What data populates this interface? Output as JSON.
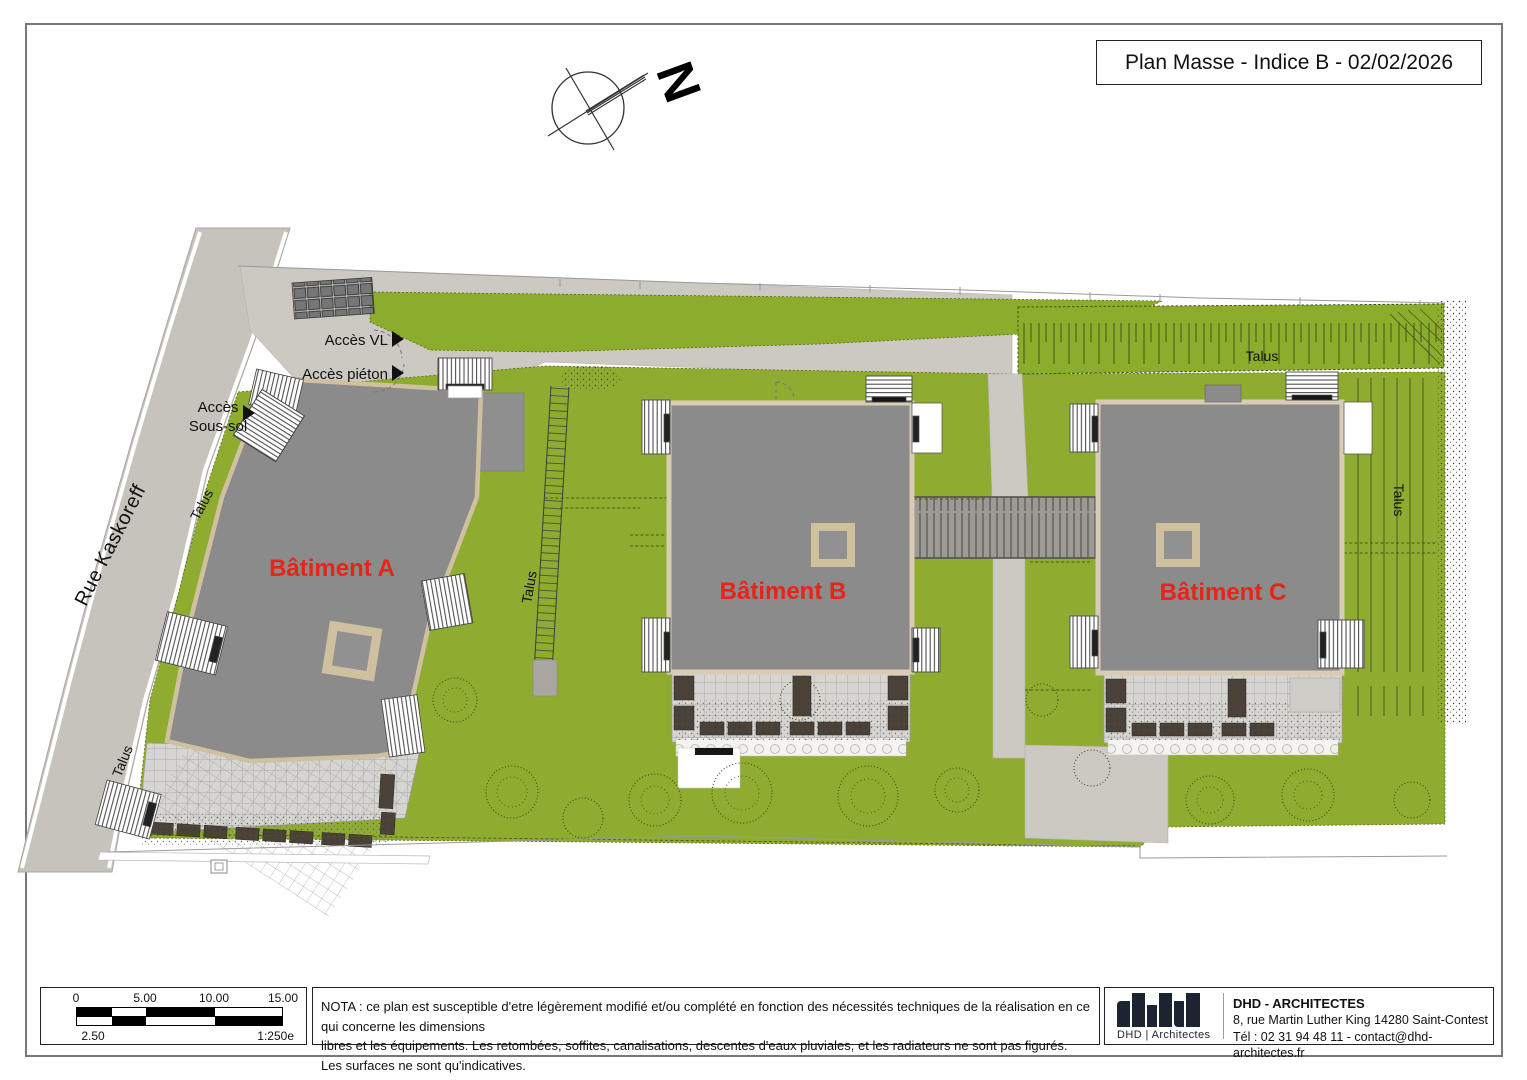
{
  "title_block": {
    "text": "Plan Masse - Indice B - 02/02/2026"
  },
  "compass": {
    "north": "N"
  },
  "street": {
    "name": "Rue Kaskoreff"
  },
  "buildings": [
    {
      "label": "Bâtiment A"
    },
    {
      "label": "Bâtiment B"
    },
    {
      "label": "Bâtiment C"
    }
  ],
  "labels": {
    "talus": "Talus",
    "acces_vl": "Accès VL",
    "acces_pieton": "Accès piéton",
    "acces_sous_sol_1": "Accès",
    "acces_sous_sol_2": "Sous-sol"
  },
  "scale_bar": {
    "tick_0": "0",
    "tick_5": "5.00",
    "tick_10": "10.00",
    "tick_15": "15.00",
    "tick_2_5": "2.50",
    "ratio": "1:250e"
  },
  "nota": {
    "line1": "NOTA : ce plan est susceptible d'etre légèrement modifié et/ou complété en fonction des nécessités techniques de la réalisation en ce qui concerne les dimensions",
    "line2": "libres et les équipements. Les retombées, soffites, canalisations, descentes d'eaux pluviales, et les radiateurs ne sont pas figurés. Les surfaces ne sont qu'indicatives."
  },
  "firm": {
    "logo_caption": "DHD | Architectes",
    "name": "DHD - ARCHITECTES",
    "address": "8, rue Martin Luther King 14280 Saint-Contest",
    "contact": "Tél : 02 31 94 48 11 - contact@dhd-architectes.fr"
  },
  "colors": {
    "lawn": "#8cac2c",
    "roof": "#8b8b8b",
    "outline_tan": "#cfc0a0",
    "paving": "#ccc8c2",
    "street": "#c6c2bc",
    "label_red": "#e82319",
    "logo_navy": "#1b2430"
  }
}
